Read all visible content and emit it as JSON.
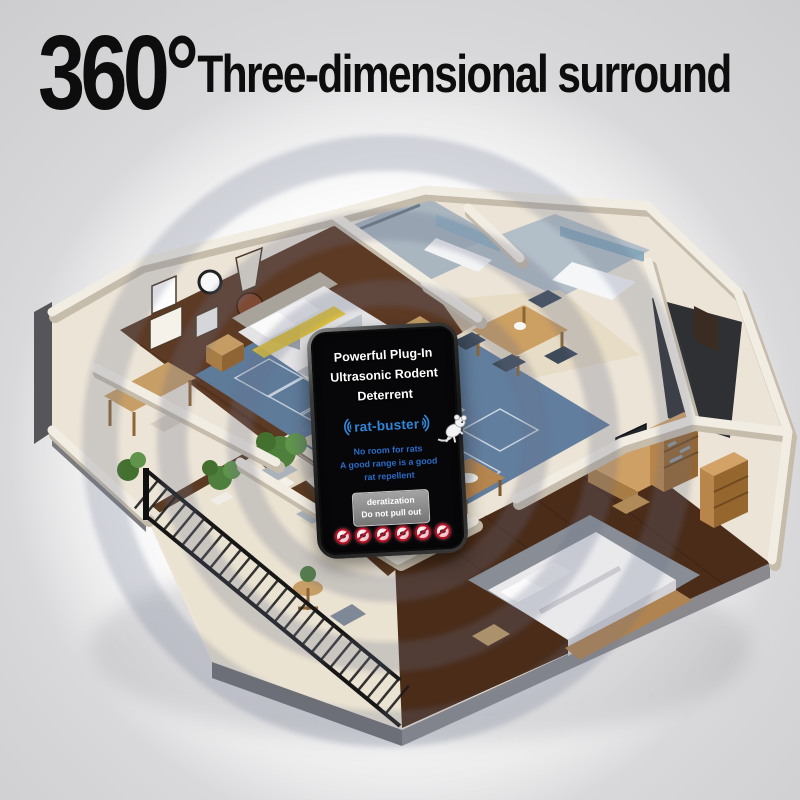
{
  "title": {
    "degree": "360°",
    "text": "Three-dimensional surround"
  },
  "device": {
    "heading": [
      "Powerful Plug-In",
      "Ultrasonic Rodent",
      "Deterrent"
    ],
    "brand": "rat-buster",
    "tagline": [
      "No room for rats",
      "A good range is a good",
      "rat repellent"
    ],
    "plug_label": [
      "deratization",
      "Do not pull out"
    ],
    "prohibition_icons": [
      "no-mouse",
      "no-cockroach",
      "no-spider",
      "no-mosquito",
      "no-fly",
      "no-ant"
    ]
  },
  "colors": {
    "title_black": "#0d0d0d",
    "brand_blue": "#2f86d8",
    "tagline_blue": "#2b6cc8",
    "prohibition_red": "#b31227",
    "sound_ring_gray": "rgba(103,113,138,0.28)",
    "background_gray": "#d6d6d8"
  }
}
